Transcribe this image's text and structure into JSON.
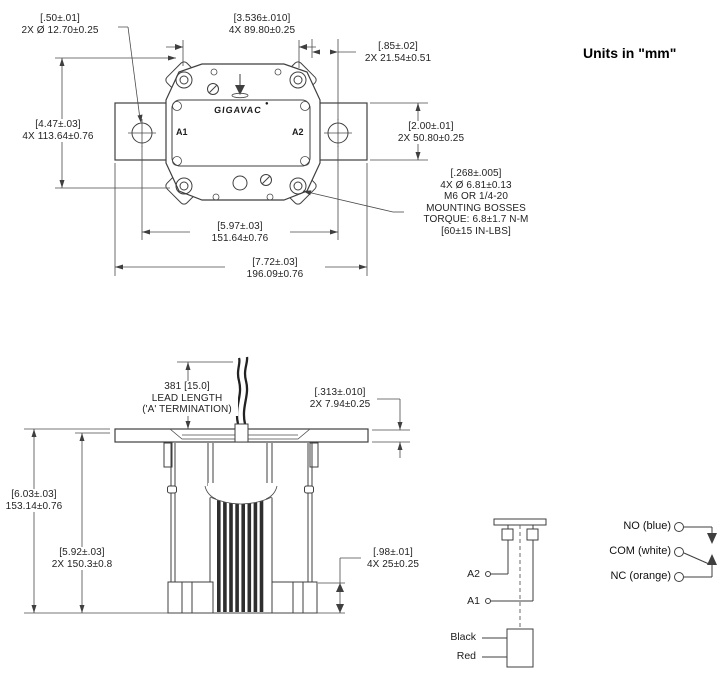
{
  "colors": {
    "background": "#ffffff",
    "ink": "#3f3f3f",
    "text": "#232323"
  },
  "note_units": "Units in \"mm\"",
  "top_view": {
    "brand": "GIGAVAC",
    "brand_mark": "●",
    "terminal_a1": "A1",
    "terminal_a2": "A2",
    "dims": {
      "hole_dia": [
        "[.50±.01]",
        "2X Ø 12.70±0.25"
      ],
      "bolt_spacing_h": [
        "[3.536±.010]",
        "4X 89.80±0.25"
      ],
      "hole_edge": [
        "[.85±.02]",
        "2X 21.54±0.51"
      ],
      "bolt_spacing_v": [
        "[4.47±.03]",
        "4X 113.64±0.76"
      ],
      "plate_height": [
        "[2.00±.01]",
        "2X 50.80±0.25"
      ],
      "hole_spacing": [
        "[5.97±.03]",
        "151.64±0.76"
      ],
      "overall_width": [
        "[7.72±.03]",
        "196.09±0.76"
      ]
    },
    "mounting_note": [
      "[.268±.005]",
      "4X Ø 6.81±0.13",
      "M6 OR 1/4-20",
      "MOUNTING BOSSES",
      "TORQUE: 6.8±1.7 N-M",
      "[60±15 IN-LBS]"
    ]
  },
  "side_view": {
    "dims": {
      "lead_length": [
        "381 [15.0]",
        "LEAD LENGTH",
        "('A' TERMINATION)"
      ],
      "lead_offset": [
        "[.313±.010]",
        "2X 7.94±0.25"
      ],
      "overall_height": [
        "[6.03±.03]",
        "153.14±0.76"
      ],
      "body_height": [
        "[5.92±.03]",
        "2X 150.3±0.8"
      ],
      "foot_height": [
        "[.98±.01]",
        "4X 25±0.25"
      ]
    }
  },
  "schematic": {
    "terminal_a2": "A2",
    "terminal_a1": "A1",
    "wire_black": "Black",
    "wire_red": "Red",
    "contacts": [
      {
        "label": "NO (blue)"
      },
      {
        "label": "COM (white)"
      },
      {
        "label": "NC (orange)"
      }
    ]
  }
}
